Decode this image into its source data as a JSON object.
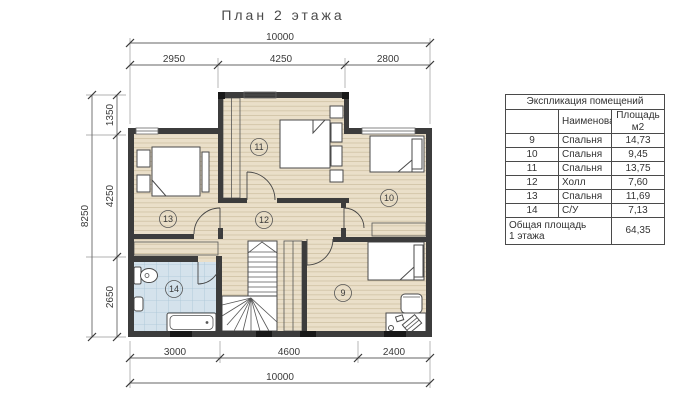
{
  "title": "План 2 этажа",
  "dims": {
    "top_total": "10000",
    "top_segs": [
      "2950",
      "4250",
      "2800"
    ],
    "left_total": "8250",
    "left_segs": [
      "1350",
      "4250",
      "2650"
    ],
    "bottom_segs": [
      "3000",
      "4600",
      "2400"
    ],
    "bottom_total": "10000"
  },
  "rooms": [
    {
      "num": "9",
      "name": "Спальня",
      "area": "14,73"
    },
    {
      "num": "10",
      "name": "Спальня",
      "area": "9,45"
    },
    {
      "num": "11",
      "name": "Спальня",
      "area": "13,75"
    },
    {
      "num": "12",
      "name": "Холл",
      "area": "7,60"
    },
    {
      "num": "13",
      "name": "Спальня",
      "area": "11,69"
    },
    {
      "num": "14",
      "name": "С/У",
      "area": "7,13"
    }
  ],
  "table": {
    "title": "Экспликация помещений",
    "col_num": "",
    "col_name": "Наименование",
    "col_area_line1": "Площадь",
    "col_area_line2": "м2",
    "total_label_line1": "Общая площадь",
    "total_label_line2": "1 этажа",
    "total_value": "64,35"
  },
  "colors": {
    "wall": "#3c3c3c",
    "floor": "#eadfc9",
    "floor_line": "#cfc2a4",
    "tile": "#d4e2ec",
    "tile_line": "#a9c5d6",
    "line": "#5a5a5a"
  }
}
